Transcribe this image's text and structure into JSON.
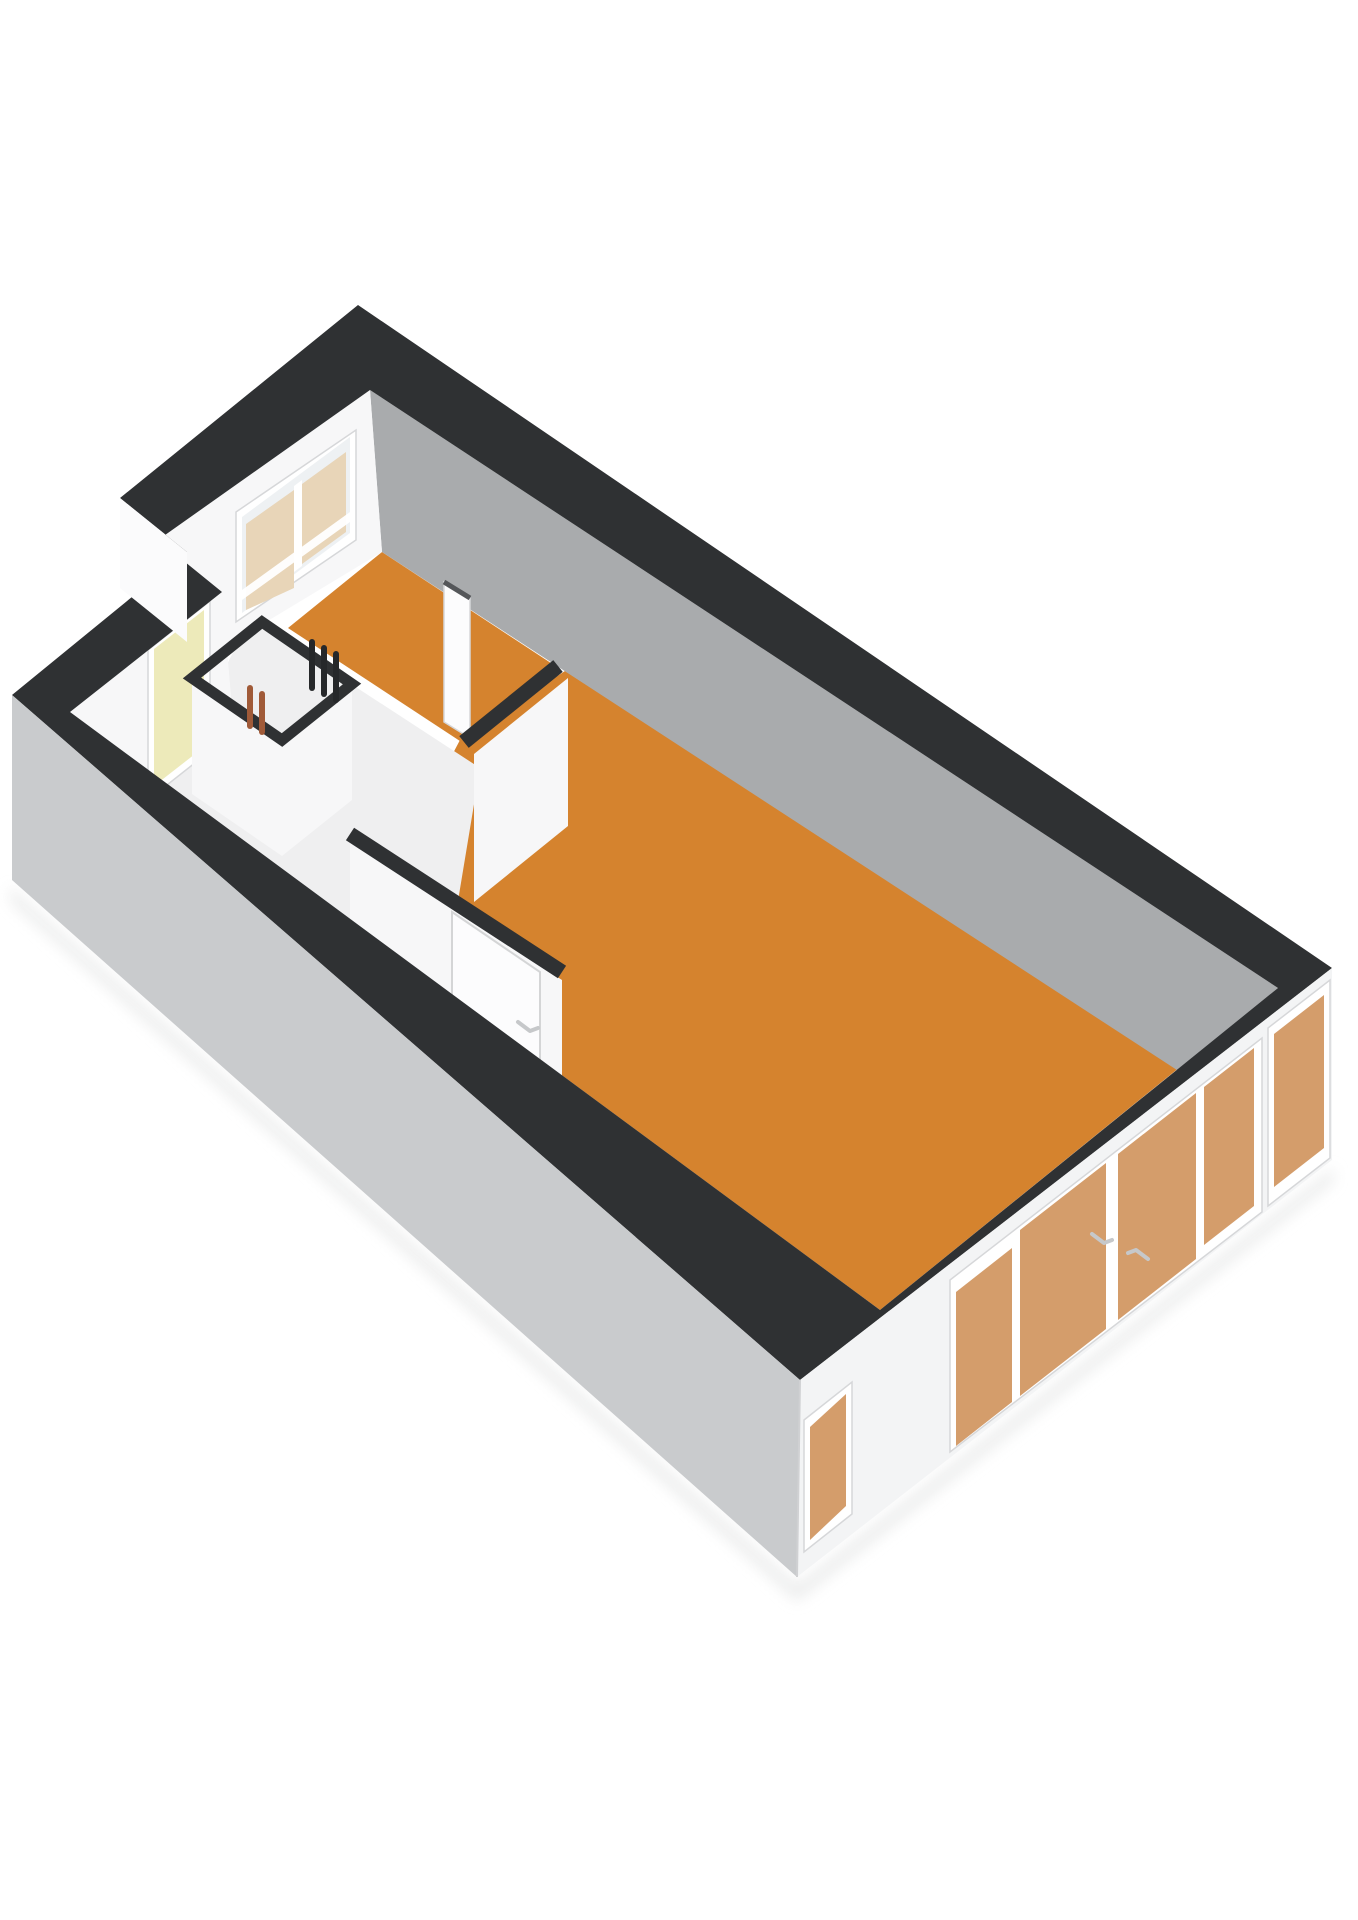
{
  "scene": {
    "kind": "3d-floorplan-render",
    "view": "axonometric-from-above",
    "background": "#ffffff",
    "contains_text": false
  },
  "colors": {
    "background": "#ffffff",
    "wall_top": "#2f3133",
    "outer_sw": "#c9cbcd",
    "outer_se": "#f3f4f5",
    "outer_step": "#fbfbfc",
    "inner_grey": "#a9abad",
    "inner_grey_sliver": "#cdcfd1",
    "inner_white": "#f7f7f8",
    "floor_orange": "#d5832e",
    "floor_light": "#efeff0",
    "glass_tint": "#d49d6b",
    "glass_clear": "#eef1f3",
    "curtain": "#e8d5b8",
    "front_door": "#edeaba",
    "pipe_dark": "#26282a",
    "pipe_copper": "#a05a38",
    "frame_white": "#ffffff",
    "frame_stroke": "#d6d7d9",
    "door_leaf": "#fcfcfd",
    "handle": "#c6c8ca",
    "shadow": "#e9eaea"
  },
  "rooms": [
    {
      "name": "large-room",
      "floor": "orange",
      "position": "south-east half"
    },
    {
      "name": "small-room",
      "floor": "orange",
      "position": "north corner, window with curtains"
    },
    {
      "name": "hallway",
      "floor": "light",
      "position": "west side, entry door"
    },
    {
      "name": "meter-closet",
      "floor": "light",
      "position": "center-west, exposed pipes"
    }
  ],
  "features": {
    "entry_door": {
      "color_key": "front_door",
      "wall": "north-west recessed wall"
    },
    "open_interior_door_leaf": {
      "color_key": "door_leaf",
      "location": "hallway"
    },
    "interior_door_with_handle": {
      "wall": "hall-to-large-room wall"
    },
    "pipes": {
      "dark_count": 3,
      "copper_count": 2
    },
    "bedroom_window": {
      "panels": 2,
      "curtain_color_key": "curtain"
    },
    "facade_windows": [
      {
        "name": "narrow-window",
        "glass": "glass_tint"
      },
      {
        "name": "french-door-group",
        "panels": 4,
        "handles": 2,
        "glass": "glass_tint"
      },
      {
        "name": "tall-corner-window",
        "glass": "glass_tint"
      }
    ]
  }
}
